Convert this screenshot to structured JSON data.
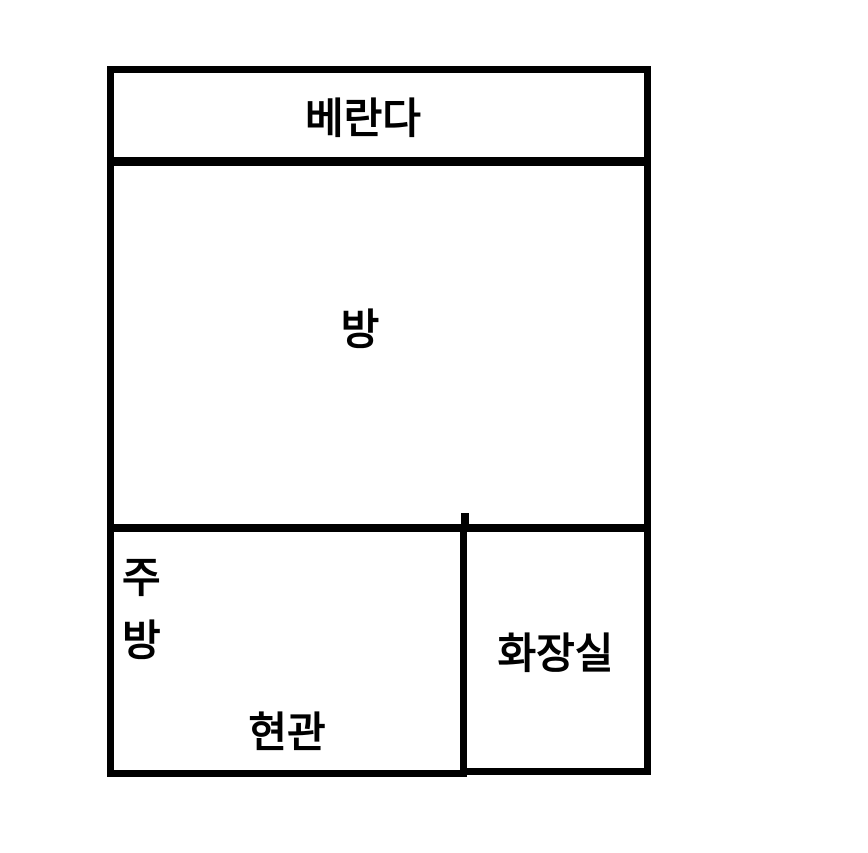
{
  "floorplan": {
    "background_color": "#ffffff",
    "wall_color": "#000000",
    "text_color": "#000000",
    "rooms": {
      "veranda": {
        "label": "베란다"
      },
      "main_room": {
        "label": "방"
      },
      "kitchen": {
        "label": "주방",
        "label_line1": "주",
        "label_line2": "방"
      },
      "entrance": {
        "label": "현관"
      },
      "bathroom": {
        "label": "화장실"
      }
    }
  }
}
